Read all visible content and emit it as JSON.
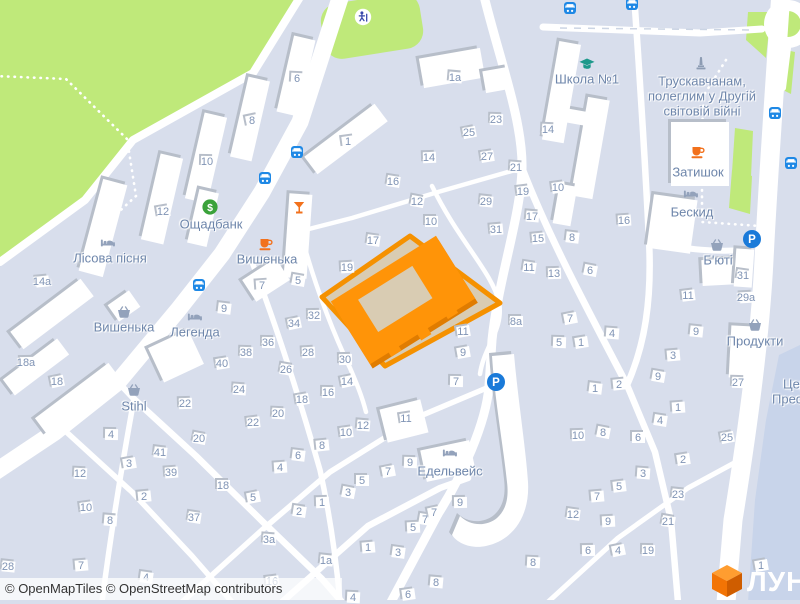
{
  "map": {
    "attribution": "© OpenMapTiles © OpenStreetMap contributors",
    "logo_text": "ЛУН",
    "colors": {
      "land": "#d8deec",
      "park_green": "#bfe97a",
      "road": "#ffffff",
      "water_area": "#c8d4ea",
      "highlight_border": "#f59100",
      "highlight_building": "#ff9408",
      "highlight_parcel": "#d9ccb3",
      "bus_icon": "#1e88e5",
      "parking_icon": "#1a7ad9",
      "bank_icon": "#3aa23a",
      "cafe_icon": "#f2711c",
      "school_icon": "#1d998b",
      "gray_poi_icon": "#93a2bb",
      "label_blue": "#6e86ab",
      "number_blue": "#8094b5"
    },
    "pois": [
      {
        "icon": "bank",
        "x": 210,
        "y": 207,
        "label": "Ощадбанк",
        "lx": 211,
        "ly": 224
      },
      {
        "icon": "lodging",
        "x": 108,
        "y": 243,
        "label": "Лісова пісня",
        "lx": 110,
        "ly": 258
      },
      {
        "icon": "shop",
        "x": 124,
        "y": 312,
        "label": "Вишенька",
        "lx": 124,
        "ly": 327
      },
      {
        "icon": "lodging",
        "x": 195,
        "y": 317,
        "label": "Легенда",
        "lx": 195,
        "ly": 332
      },
      {
        "icon": "shop",
        "x": 134,
        "y": 390,
        "label": "Stihl",
        "lx": 134,
        "ly": 406
      },
      {
        "icon": "cafe",
        "x": 266,
        "y": 244,
        "label": "Вишенька",
        "lx": 267,
        "ly": 259
      },
      {
        "icon": "bar",
        "x": 299,
        "y": 208
      },
      {
        "icon": "school",
        "x": 587,
        "y": 64,
        "label": "Школа №1",
        "lx": 587,
        "ly": 79
      },
      {
        "icon": "monument",
        "x": 701,
        "y": 63,
        "lines": [
          {
            "t": "Трускавчанам,",
            "x": 702,
            "y": 81
          },
          {
            "t": "полеглим у Другій",
            "x": 702,
            "y": 96
          },
          {
            "t": "світовій війні",
            "x": 702,
            "y": 111
          }
        ]
      },
      {
        "icon": "cafe",
        "x": 698,
        "y": 152,
        "label": "Затишок",
        "lx": 698,
        "ly": 172
      },
      {
        "icon": "lodging",
        "x": 691,
        "y": 194,
        "label": "Бескид",
        "lx": 692,
        "ly": 212
      },
      {
        "icon": "shop",
        "x": 717,
        "y": 245,
        "label": "Б'юті",
        "lx": 718,
        "ly": 260
      },
      {
        "icon": "shop",
        "x": 755,
        "y": 325,
        "label": "Продукти",
        "lx": 755,
        "ly": 341
      },
      {
        "icon": "lodging",
        "x": 450,
        "y": 453,
        "label": "Едельвейс",
        "lx": 450,
        "ly": 471
      },
      {
        "lines": [
          {
            "t": "Цер",
            "x": 783,
            "y": 384,
            "align": "left"
          },
          {
            "t": "Пресвя",
            "x": 772,
            "y": 399,
            "align": "left"
          }
        ]
      }
    ],
    "transit": {
      "bus_stops": [
        [
          265,
          178
        ],
        [
          297,
          152
        ],
        [
          199,
          285
        ],
        [
          570,
          8
        ],
        [
          632,
          4
        ],
        [
          775,
          113
        ],
        [
          791,
          163
        ]
      ],
      "parking": [
        [
          752,
          239
        ],
        [
          496,
          382
        ]
      ],
      "playground": [
        [
          363,
          17
        ]
      ]
    },
    "house_numbers": [
      [
        252,
        121,
        "8"
      ],
      [
        207,
        162,
        "10"
      ],
      [
        163,
        212,
        "12"
      ],
      [
        297,
        79,
        "6"
      ],
      [
        348,
        142,
        "1"
      ],
      [
        455,
        78,
        "1a"
      ],
      [
        42,
        282,
        "14a"
      ],
      [
        224,
        309,
        "9"
      ],
      [
        262,
        286,
        "7"
      ],
      [
        393,
        182,
        "16"
      ],
      [
        429,
        158,
        "14"
      ],
      [
        417,
        202,
        "12"
      ],
      [
        431,
        222,
        "10"
      ],
      [
        469,
        133,
        "25"
      ],
      [
        496,
        120,
        "23"
      ],
      [
        487,
        157,
        "27"
      ],
      [
        516,
        168,
        "21"
      ],
      [
        523,
        192,
        "19"
      ],
      [
        486,
        202,
        "29"
      ],
      [
        496,
        230,
        "31"
      ],
      [
        373,
        241,
        "17"
      ],
      [
        347,
        268,
        "19"
      ],
      [
        298,
        281,
        "5"
      ],
      [
        314,
        316,
        "32"
      ],
      [
        294,
        324,
        "34"
      ],
      [
        268,
        343,
        "36"
      ],
      [
        463,
        332,
        "11"
      ],
      [
        548,
        130,
        "14"
      ],
      [
        558,
        188,
        "10"
      ],
      [
        532,
        217,
        "17"
      ],
      [
        538,
        239,
        "15"
      ],
      [
        572,
        238,
        "8"
      ],
      [
        624,
        221,
        "16"
      ],
      [
        529,
        268,
        "11"
      ],
      [
        554,
        274,
        "13"
      ],
      [
        590,
        271,
        "6"
      ],
      [
        516,
        322,
        "8a"
      ],
      [
        570,
        319,
        "7"
      ],
      [
        559,
        343,
        "5"
      ],
      [
        581,
        343,
        "1"
      ],
      [
        612,
        334,
        "4"
      ],
      [
        688,
        296,
        "11"
      ],
      [
        696,
        332,
        "9"
      ],
      [
        673,
        356,
        "3"
      ],
      [
        743,
        276,
        "31"
      ],
      [
        746,
        298,
        "29a"
      ],
      [
        658,
        377,
        "9"
      ],
      [
        26,
        363,
        "18a"
      ],
      [
        57,
        382,
        "18"
      ],
      [
        111,
        435,
        "4"
      ],
      [
        129,
        464,
        "3"
      ],
      [
        80,
        474,
        "12"
      ],
      [
        86,
        508,
        "10"
      ],
      [
        110,
        521,
        "8"
      ],
      [
        144,
        497,
        "2"
      ],
      [
        160,
        453,
        "41"
      ],
      [
        171,
        473,
        "39"
      ],
      [
        194,
        518,
        "37"
      ],
      [
        185,
        404,
        "22"
      ],
      [
        199,
        439,
        "20"
      ],
      [
        223,
        486,
        "18"
      ],
      [
        253,
        498,
        "5"
      ],
      [
        246,
        353,
        "38"
      ],
      [
        222,
        364,
        "40"
      ],
      [
        239,
        390,
        "24"
      ],
      [
        253,
        423,
        "22"
      ],
      [
        8,
        567,
        "28"
      ],
      [
        81,
        566,
        "7"
      ],
      [
        146,
        578,
        "4"
      ],
      [
        308,
        353,
        "28"
      ],
      [
        286,
        370,
        "26"
      ],
      [
        345,
        360,
        "30"
      ],
      [
        347,
        382,
        "14"
      ],
      [
        328,
        393,
        "16"
      ],
      [
        302,
        400,
        "18"
      ],
      [
        278,
        414,
        "20"
      ],
      [
        346,
        433,
        "10"
      ],
      [
        363,
        426,
        "12"
      ],
      [
        322,
        446,
        "8"
      ],
      [
        298,
        456,
        "6"
      ],
      [
        280,
        468,
        "4"
      ],
      [
        299,
        512,
        "2"
      ],
      [
        322,
        503,
        "1"
      ],
      [
        348,
        493,
        "3"
      ],
      [
        362,
        481,
        "5"
      ],
      [
        388,
        472,
        "7"
      ],
      [
        410,
        463,
        "9"
      ],
      [
        406,
        419,
        "11"
      ],
      [
        269,
        540,
        "3a"
      ],
      [
        272,
        582,
        "16"
      ],
      [
        326,
        561,
        "1a"
      ],
      [
        368,
        548,
        "1"
      ],
      [
        398,
        553,
        "3"
      ],
      [
        413,
        528,
        "5"
      ],
      [
        425,
        520,
        "7"
      ],
      [
        460,
        503,
        "9"
      ],
      [
        434,
        513,
        "7"
      ],
      [
        456,
        382,
        "7"
      ],
      [
        463,
        353,
        "9"
      ],
      [
        353,
        598,
        "4"
      ],
      [
        408,
        595,
        "6"
      ],
      [
        436,
        583,
        "8"
      ],
      [
        619,
        385,
        "2"
      ],
      [
        595,
        389,
        "1"
      ],
      [
        678,
        408,
        "1"
      ],
      [
        660,
        421,
        "4"
      ],
      [
        578,
        436,
        "10"
      ],
      [
        603,
        433,
        "8"
      ],
      [
        638,
        438,
        "6"
      ],
      [
        727,
        438,
        "25"
      ],
      [
        738,
        383,
        "27"
      ],
      [
        683,
        460,
        "2"
      ],
      [
        643,
        474,
        "3"
      ],
      [
        619,
        487,
        "5"
      ],
      [
        678,
        495,
        "23"
      ],
      [
        597,
        497,
        "7"
      ],
      [
        573,
        515,
        "12"
      ],
      [
        608,
        522,
        "9"
      ],
      [
        668,
        522,
        "21"
      ],
      [
        588,
        551,
        "6"
      ],
      [
        618,
        551,
        "4"
      ],
      [
        648,
        551,
        "19"
      ],
      [
        761,
        566,
        "1"
      ],
      [
        533,
        563,
        "8"
      ]
    ]
  }
}
